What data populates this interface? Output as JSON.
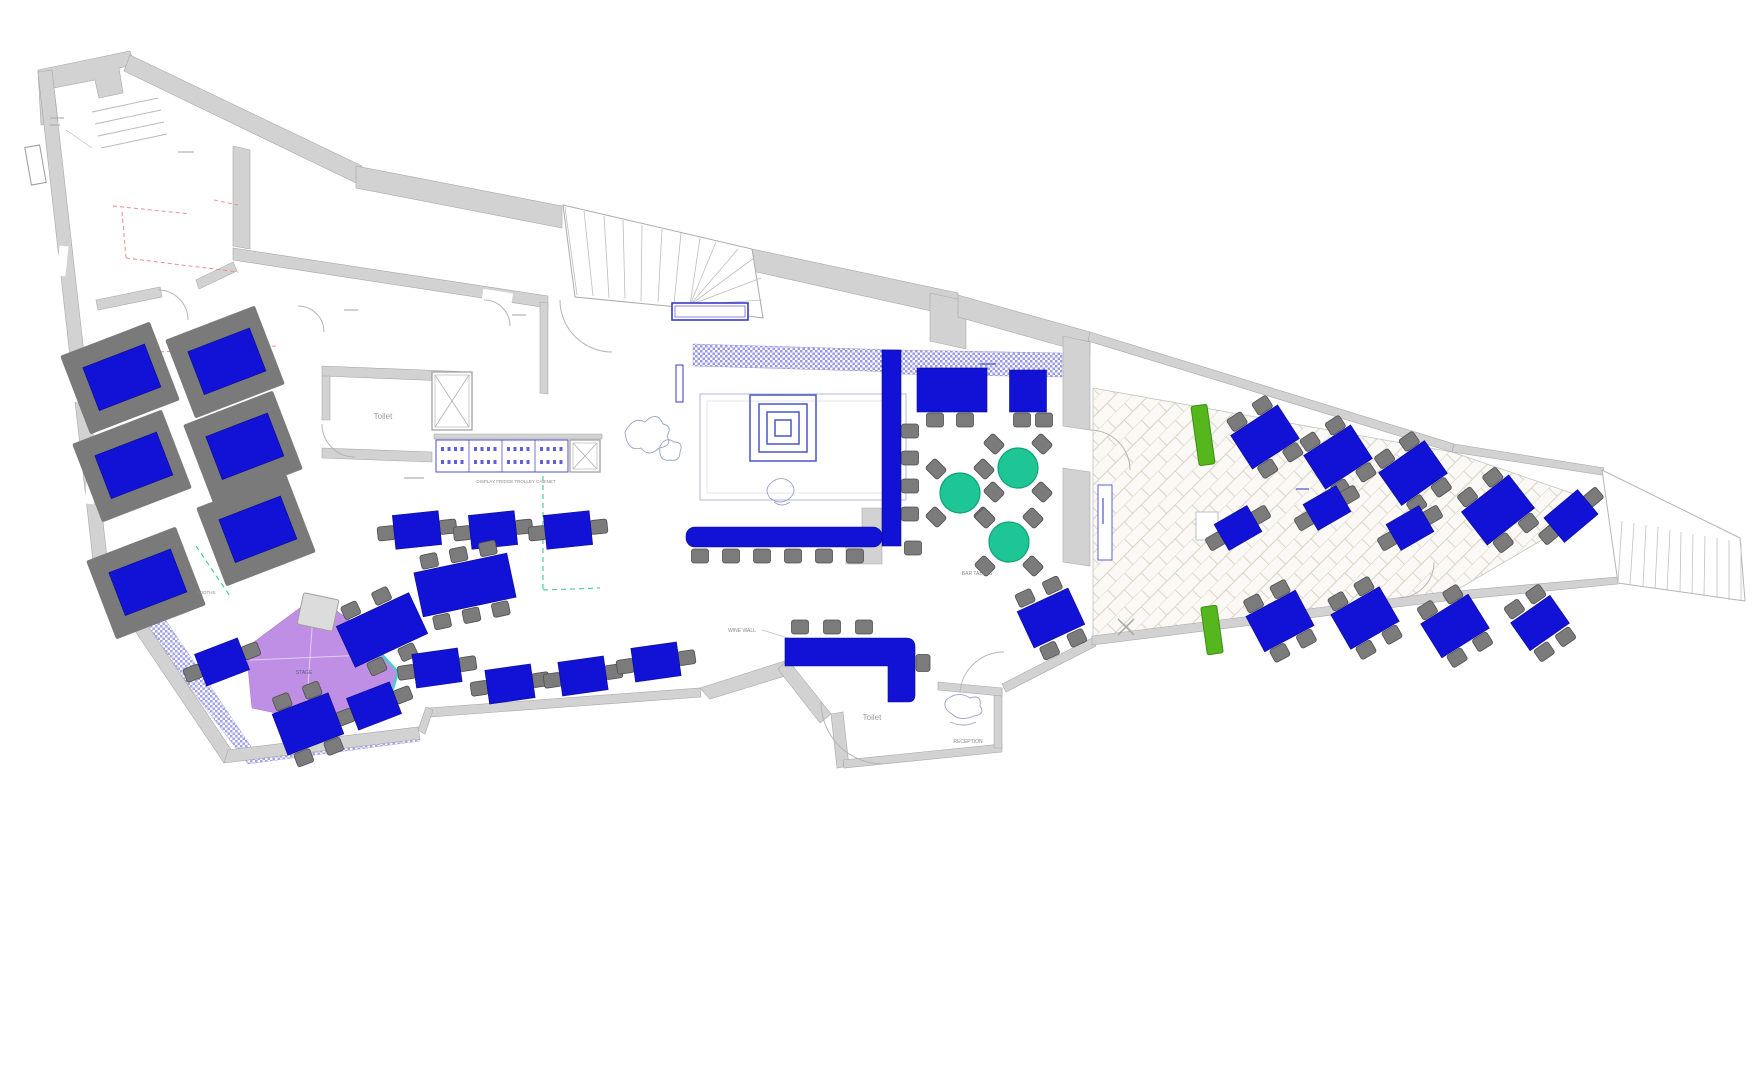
{
  "meta": {
    "drawing": "restaurant-floor-plan"
  },
  "colors": {
    "table_blue": "#1212d6",
    "table_blue_edge": "#0b0b8f",
    "chair_gray": "#7b7b7b",
    "chair_edge": "#4f4f4f",
    "booth_gray": "#7a7a7a",
    "wall_fill": "#d2d2d2",
    "wall_edge": "#a8a8a8",
    "green_table": "#1ec695",
    "green_table_edge": "#0da377",
    "planter_green": "#55b61e",
    "planter_edge": "#3c8f12",
    "stage_purple": "#bf8fe6",
    "teal_edge": "#3ed2c6",
    "hatch": "#4343d6",
    "red_dash": "#e89090",
    "green_dash": "#3cc98c",
    "blue_line": "#3a3ac8",
    "arc_gray": "#b5b5b5",
    "label_gray": "#8a8a8a"
  },
  "labels": [
    {
      "text": "Toilet",
      "x": 383,
      "y": 419,
      "size": 8,
      "color": "#9a9a9a"
    },
    {
      "text": "Toilet",
      "x": 872,
      "y": 720,
      "size": 8,
      "color": "#9a9a9a"
    },
    {
      "text": "RECEPTION",
      "x": 968,
      "y": 743,
      "size": 5,
      "color": "#8a8a8a"
    },
    {
      "text": "BAR TABLES",
      "x": 977,
      "y": 575,
      "size": 5,
      "color": "#8a8a8a"
    },
    {
      "text": "WINE WALL",
      "x": 742,
      "y": 632,
      "size": 5,
      "color": "#8a8a8a"
    },
    {
      "text": "DISPLAY FRIDGE TROLLEY CABINET",
      "x": 516,
      "y": 483,
      "size": 4.5,
      "color": "#8a8a8a"
    },
    {
      "text": "STAGE",
      "x": 304,
      "y": 674,
      "size": 5,
      "color": "#5a5a7e"
    },
    {
      "text": "BOOTHS",
      "x": 206,
      "y": 594,
      "size": 4.5,
      "color": "#8a8a8a"
    }
  ],
  "walls": [
    "M38,70 L130,51 L134,65 L119,68 L123,93 L99,98 L95,80 L54,88 L58,121 L41,125 Z",
    "M130,55 L362,166 L356,183 L124,71 Z",
    "M356,166 L562,206 L562,228 L356,188 Z",
    "M752,249 L958,293 L958,317 L752,271 Z",
    "M930,293 L966,301 L966,349 L930,341 Z",
    "M958,295 L1090,332 L1090,354 L958,317 Z",
    "M38,72 L52,70 L108,566 L94,570 Z",
    "M94,570 L108,566 L234,754 L224,763 Z",
    "M224,763 L420,739 L418,727 L228,750 Z",
    "M233,146 L250,150 L250,249 L233,246 Z",
    "M233,248 L548,296 L548,308 L233,260 Z",
    "M540,302 L548,303 L548,394 L540,393 Z",
    "M322,366 L472,372 L472,382 L322,376 Z",
    "M322,448 L432,452 L432,462 L322,458 Z",
    "M322,376 L330,376 L330,420 L322,420 Z",
    "M1063,336 L1090,342 L1090,430 L1063,426 Z",
    "M1063,468 L1090,472 L1090,566 L1063,562 Z",
    "M700,688 L788,660 L795,673 L710,699 Z",
    "M788,660 L831,714 L820,723 L778,669 Z",
    "M831,714 L843,712 L849,766 L837,768 Z",
    "M843,760 L1002,744 L1002,752 L844,768 Z",
    "M994,688 L1002,688 L1002,748 L994,748 Z",
    "M938,682 L1002,688 L1002,696 L938,690 Z",
    "M428,708 L700,688 L701,697 L429,717 Z",
    "M418,730 L426,707 L433,710 L425,734 Z",
    "M1002,684 L1092,638 L1096,646 L1006,692 Z",
    "M1092,636 L1444,592 L1445,601 L1092,645 Z",
    "M1444,592 L1618,577 L1618,584 L1445,601 Z",
    "M1090,332 L1454,444 L1452,452 L1088,341 Z",
    "M1454,444 L1604,468 L1602,475 L1452,452 Z",
    "M96,300 L160,287 L162,297 L98,310 Z",
    "M196,280 L233,262 L237,271 L199,289 Z",
    "M434,434 L602,434 L602,439 L434,439 Z",
    "M862,508 L882,508 L882,564 L846,564 L846,546 L862,546 Z"
  ],
  "gaps": [
    {
      "x": 298,
      "y": 293,
      "w": 30,
      "h": 16,
      "r": 9
    },
    {
      "x": 482,
      "y": 291,
      "w": 30,
      "h": 16,
      "r": 9
    },
    {
      "x": 58,
      "y": 246,
      "w": 9,
      "h": 30,
      "r": 6
    },
    {
      "x": 72,
      "y": 372,
      "w": 9,
      "h": 30,
      "r": 6
    },
    {
      "x": 86,
      "y": 474,
      "w": 9,
      "h": 30,
      "r": 6
    }
  ],
  "arcs": [
    "M322,424 A33,33 0 0 0 355,457",
    "M298,306 A26,26 0 0 1 324,332",
    "M484,300 A26,26 0 0 1 510,326",
    "M158,290 A30,30 0 0 1 188,320",
    "M560,300 A52,52 0 0 0 612,352",
    "M1090,430 A40,40 0 0 1 1130,470",
    "M821,702 A62,62 0 0 0 883,764",
    "M1004,652 A44,44 0 0 0 960,692",
    "M1398,598 A36,36 0 0 0 1434,562"
  ],
  "red_dash": [
    [
      113,
      206,
      190,
      214
    ],
    [
      122,
      212,
      126,
      258
    ],
    [
      126,
      258,
      238,
      272
    ],
    [
      214,
      200,
      238,
      205
    ],
    [
      118,
      354,
      276,
      346
    ]
  ],
  "green_dash": [
    [
      543,
      458,
      543,
      592
    ],
    [
      543,
      590,
      600,
      588
    ],
    [
      196,
      546,
      230,
      596
    ]
  ],
  "leaders": [
    [
      762,
      630,
      798,
      641
    ],
    [
      66,
      130,
      92,
      148
    ]
  ],
  "checker_bands": [
    "M693,344 L900,350 L900,372 L693,366 Z",
    "M900,350 L1062,353 L1062,377 L900,374 Z"
  ],
  "hatch_band": "M112,582 L136,576 L252,748 L418,727 L420,741 L248,764 L116,590 Z",
  "terrace_poly": "1093,388 1452,452 1580,496 1576,520 1443,598 1093,640",
  "stage": {
    "poly": "316,596 352,622 398,672 386,712 300,718 252,708 246,648",
    "teal_edge": "M352,622 L398,672 L386,712",
    "seams": [
      [
        250,
        660,
        392,
        654
      ],
      [
        314,
        600,
        306,
        714
      ]
    ],
    "podium": {
      "x": 318,
      "y": 612,
      "w": 36,
      "h": 32,
      "r": 12
    }
  },
  "spiral": {
    "cx": 783,
    "cy": 428,
    "sizes": [
      66,
      48,
      32,
      16
    ]
  },
  "spiral_room": {
    "x": 700,
    "y": 394,
    "w": 206,
    "h": 106
  },
  "stair_main": {
    "outline": "M563,205 L752,249 L763,318 L688,308 L575,297 Z",
    "lines": [
      [
        565,
        207,
        577,
        295
      ],
      [
        584,
        211,
        593,
        296
      ],
      [
        604,
        216,
        609,
        298
      ],
      [
        623,
        220,
        625,
        299
      ],
      [
        642,
        225,
        641,
        301
      ],
      [
        662,
        229,
        658,
        302
      ],
      [
        681,
        233,
        674,
        304
      ],
      [
        700,
        238,
        690,
        305
      ],
      [
        690,
        305,
        716,
        242
      ],
      [
        690,
        305,
        738,
        249
      ],
      [
        690,
        305,
        754,
        258
      ],
      [
        690,
        305,
        761,
        278
      ],
      [
        690,
        305,
        762,
        300
      ]
    ]
  },
  "steps_right": {
    "outline": "M1602,470 L1740,538 L1745,601 L1618,583 Z",
    "lines": [
      [
        1622,
        521,
        1618,
        583
      ],
      [
        1634,
        523,
        1630,
        585
      ],
      [
        1646,
        525,
        1643,
        587
      ],
      [
        1658,
        527,
        1655,
        589
      ],
      [
        1670,
        530,
        1667,
        591
      ],
      [
        1681,
        532,
        1680,
        592
      ],
      [
        1693,
        534,
        1692,
        594
      ],
      [
        1705,
        536,
        1704,
        596
      ],
      [
        1717,
        538,
        1717,
        598
      ],
      [
        1729,
        540,
        1729,
        600
      ],
      [
        1741,
        543,
        1741,
        601
      ]
    ]
  },
  "steps_entry": [
    [
      92,
      112,
      158,
      98
    ],
    [
      95,
      124,
      161,
      110
    ],
    [
      98,
      136,
      164,
      122
    ],
    [
      101,
      148,
      167,
      134
    ]
  ],
  "door_leaf": {
    "x": 28,
    "y": 146,
    "w": 15,
    "h": 38,
    "r": -10
  },
  "lifts": [
    {
      "x": 432,
      "y": 372,
      "w": 40,
      "h": 58
    },
    {
      "x": 570,
      "y": 440,
      "w": 30,
      "h": 32
    }
  ],
  "cabinets": {
    "x": 436,
    "y": 440,
    "w": 132,
    "h": 32,
    "cells": 4
  },
  "landing": {
    "x": 672,
    "y": 303,
    "w": 76,
    "h": 17
  },
  "blue_slot": {
    "x": 676,
    "y": 365,
    "w": 7,
    "h": 37
  },
  "menu_board": {
    "x": 1098,
    "y": 485,
    "w": 14,
    "h": 75
  },
  "pit": {
    "x": 1196,
    "y": 512,
    "w": 22,
    "h": 28
  },
  "xmark": {
    "x": 1126,
    "y": 627
  },
  "squiggles": [
    "M625,432 q8,-16 20,-10 q12,-12 18,2 q10,2 4,12 q6,10 -8,12 q-10,10 -18,0 q-14,4 -16,-16",
    "M660,446 q6,-10 14,-4 q10,0 6,10 q0,10 -10,8 q-12,2 -10,-14",
    "M770,484 q10,-10 20,-2 q8,8 0,16 q-10,8 -20,0 q-6,-8 0,-14 M774,502 q8,6 16,0",
    "M946,700 q12,-10 24,-2 q12,-4 10,8 q6,8 -6,10 q-14,6 -22,-2 q-10,-6 -6,-14 M950,722 q14,6 26,0"
  ],
  "booths": [
    {
      "x": 120,
      "y": 378
    },
    {
      "x": 225,
      "y": 362
    },
    {
      "x": 132,
      "y": 466
    },
    {
      "x": 243,
      "y": 447
    },
    {
      "x": 146,
      "y": 583
    },
    {
      "x": 256,
      "y": 530
    }
  ],
  "booth_rot": -21,
  "tables": [
    {
      "x": 417,
      "y": 530,
      "r": -6
    },
    {
      "x": 493,
      "y": 530,
      "r": -6
    },
    {
      "x": 568,
      "y": 530,
      "r": -6
    },
    {
      "x": 465,
      "y": 585,
      "r": -12,
      "w": 95,
      "h": 45,
      "c": [
        [
          -30,
          -31
        ],
        [
          0,
          -31
        ],
        [
          30,
          -31
        ],
        [
          -30,
          31
        ],
        [
          0,
          31
        ],
        [
          30,
          31
        ]
      ]
    },
    {
      "x": 382,
      "y": 630,
      "r": -25,
      "w": 80,
      "h": 45,
      "c": [
        [
          -20,
          -31
        ],
        [
          14,
          -31
        ],
        [
          -20,
          31
        ],
        [
          14,
          31
        ]
      ]
    },
    {
      "x": 437,
      "y": 668,
      "r": -8
    },
    {
      "x": 510,
      "y": 684,
      "r": -8
    },
    {
      "x": 583,
      "y": 676,
      "r": -8
    },
    {
      "x": 656,
      "y": 662,
      "r": -8
    },
    {
      "x": 222,
      "y": 662,
      "r": -21
    },
    {
      "x": 374,
      "y": 706,
      "r": -21
    },
    {
      "x": 308,
      "y": 724,
      "r": -21,
      "w": 60,
      "h": 44,
      "c": [
        [
          -16,
          -30
        ],
        [
          16,
          -30
        ],
        [
          -16,
          30
        ],
        [
          16,
          30
        ]
      ]
    },
    {
      "x": 1051,
      "y": 618,
      "r": -25,
      "w": 56,
      "h": 40,
      "c": [
        [
          -15,
          -29
        ],
        [
          15,
          -29
        ],
        [
          -15,
          29
        ],
        [
          15,
          29
        ]
      ]
    },
    {
      "x": 1265,
      "y": 437,
      "r": -33,
      "w": 56,
      "h": 40,
      "c": [
        [
          -15,
          -28
        ],
        [
          15,
          -28
        ],
        [
          -15,
          28
        ],
        [
          15,
          28
        ]
      ],
      "t": "terrace-table"
    },
    {
      "x": 1338,
      "y": 457,
      "r": -33,
      "w": 56,
      "h": 40,
      "c": [
        [
          -15,
          -28
        ],
        [
          15,
          -28
        ],
        [
          -15,
          28
        ],
        [
          15,
          28
        ]
      ],
      "t": "terrace-table"
    },
    {
      "x": 1413,
      "y": 473,
      "r": -35,
      "w": 56,
      "h": 40,
      "c": [
        [
          -15,
          -28
        ],
        [
          15,
          -28
        ],
        [
          -15,
          28
        ],
        [
          15,
          28
        ]
      ],
      "t": "terrace-table"
    },
    {
      "x": 1498,
      "y": 510,
      "r": -38,
      "w": 60,
      "h": 42,
      "c": [
        [
          -16,
          -29
        ],
        [
          16,
          -29
        ],
        [
          -16,
          29
        ],
        [
          16,
          29
        ]
      ],
      "t": "terrace-table"
    },
    {
      "x": 1280,
      "y": 621,
      "r": -28,
      "w": 56,
      "h": 40,
      "c": [
        [
          -15,
          -28
        ],
        [
          15,
          -28
        ],
        [
          -15,
          28
        ],
        [
          15,
          28
        ]
      ],
      "t": "terrace-table"
    },
    {
      "x": 1365,
      "y": 618,
      "r": -30,
      "w": 56,
      "h": 40,
      "c": [
        [
          -15,
          -28
        ],
        [
          15,
          -28
        ],
        [
          -15,
          28
        ],
        [
          15,
          28
        ]
      ],
      "t": "terrace-table"
    },
    {
      "x": 1455,
      "y": 626,
      "r": -32,
      "w": 56,
      "h": 40,
      "c": [
        [
          -15,
          -28
        ],
        [
          15,
          -28
        ],
        [
          -15,
          28
        ],
        [
          15,
          28
        ]
      ],
      "t": "terrace-table"
    },
    {
      "x": 1540,
      "y": 623,
      "r": -35,
      "w": 48,
      "h": 34,
      "c": [
        [
          -13,
          -26
        ],
        [
          13,
          -26
        ],
        [
          -13,
          26
        ],
        [
          13,
          26
        ]
      ],
      "t": "terrace-table"
    },
    {
      "x": 1571,
      "y": 516,
      "r": -40,
      "w": 44,
      "h": 32,
      "c": [
        [
          -29,
          0
        ],
        [
          29,
          0
        ]
      ],
      "t": "terrace-table"
    },
    {
      "x": 1238,
      "y": 528,
      "r": -30,
      "w": 38,
      "h": 30,
      "c": [
        [
          -26,
          0
        ],
        [
          26,
          0
        ]
      ],
      "t": "terrace-table"
    },
    {
      "x": 1327,
      "y": 508,
      "r": -30,
      "w": 38,
      "h": 30,
      "c": [
        [
          -26,
          0
        ],
        [
          26,
          0
        ]
      ],
      "t": "terrace-table"
    },
    {
      "x": 1410,
      "y": 528,
      "r": -30,
      "w": 38,
      "h": 30,
      "c": [
        [
          -26,
          0
        ],
        [
          26,
          0
        ]
      ],
      "t": "terrace-table"
    },
    {
      "x": 952,
      "y": 390,
      "r": 0,
      "w": 70,
      "h": 44,
      "c": [
        [
          -17,
          30
        ],
        [
          13,
          30
        ]
      ],
      "t": "bar-high-table"
    },
    {
      "x": 1028,
      "y": 391,
      "r": 0,
      "w": 37,
      "h": 42,
      "c": [
        [
          -6,
          29
        ],
        [
          16,
          29
        ]
      ],
      "t": "bar-high-table"
    }
  ],
  "default_table": {
    "w": 46,
    "h": 34,
    "c": [
      [
        -31,
        0
      ],
      [
        31,
        0
      ]
    ]
  },
  "green_tables": [
    {
      "x": 960,
      "y": 493
    },
    {
      "x": 1018,
      "y": 468
    },
    {
      "x": 1009,
      "y": 542
    }
  ],
  "green_chair_offsets": [
    [
      -24,
      -24
    ],
    [
      24,
      -24
    ],
    [
      -24,
      24
    ],
    [
      24,
      24
    ]
  ],
  "bench": {
    "x": 686,
    "y": 527,
    "w": 196,
    "h": 20
  },
  "bench_chairs": [
    [
      700,
      556
    ],
    [
      731,
      556
    ],
    [
      762,
      556
    ],
    [
      793,
      556
    ],
    [
      824,
      556
    ],
    [
      855,
      556
    ]
  ],
  "counter": {
    "x": 882,
    "y": 350,
    "w": 19,
    "h": 196
  },
  "bar_stools": [
    [
      910,
      431
    ],
    [
      910,
      458
    ],
    [
      910,
      486
    ],
    [
      910,
      514
    ],
    [
      913,
      548
    ]
  ],
  "l_banquette": {
    "path": "M785,638 L906,638 Q915,638 915,647 L915,695 Q915,702 908,702 L888,702 L888,666 L785,666 Z",
    "chairs": [
      [
        800,
        627,
        0
      ],
      [
        832,
        627,
        0
      ],
      [
        864,
        627,
        0
      ],
      [
        923,
        663,
        90
      ]
    ]
  },
  "planters": [
    {
      "x": 1195,
      "y": 405,
      "w": 16,
      "h": 60,
      "r": -8
    },
    {
      "x": 1204,
      "y": 606,
      "w": 16,
      "h": 48,
      "r": -8
    }
  ],
  "tiny_marks": [
    {
      "x": 50,
      "y": 118,
      "len": 14
    },
    {
      "x": 50,
      "y": 125,
      "len": 10
    },
    {
      "x": 178,
      "y": 152,
      "len": 16
    },
    {
      "x": 344,
      "y": 310,
      "len": 14
    },
    {
      "x": 512,
      "y": 315,
      "len": 14
    },
    {
      "x": 404,
      "y": 478,
      "len": 20
    },
    {
      "x": 980,
      "y": 364,
      "len": 16,
      "color": "#5050c8"
    },
    {
      "x": 1296,
      "y": 489,
      "len": 13,
      "color": "#5050c8"
    },
    {
      "x": 1103,
      "y": 498,
      "len": 26,
      "vert": true,
      "color": "#5050c8"
    }
  ]
}
